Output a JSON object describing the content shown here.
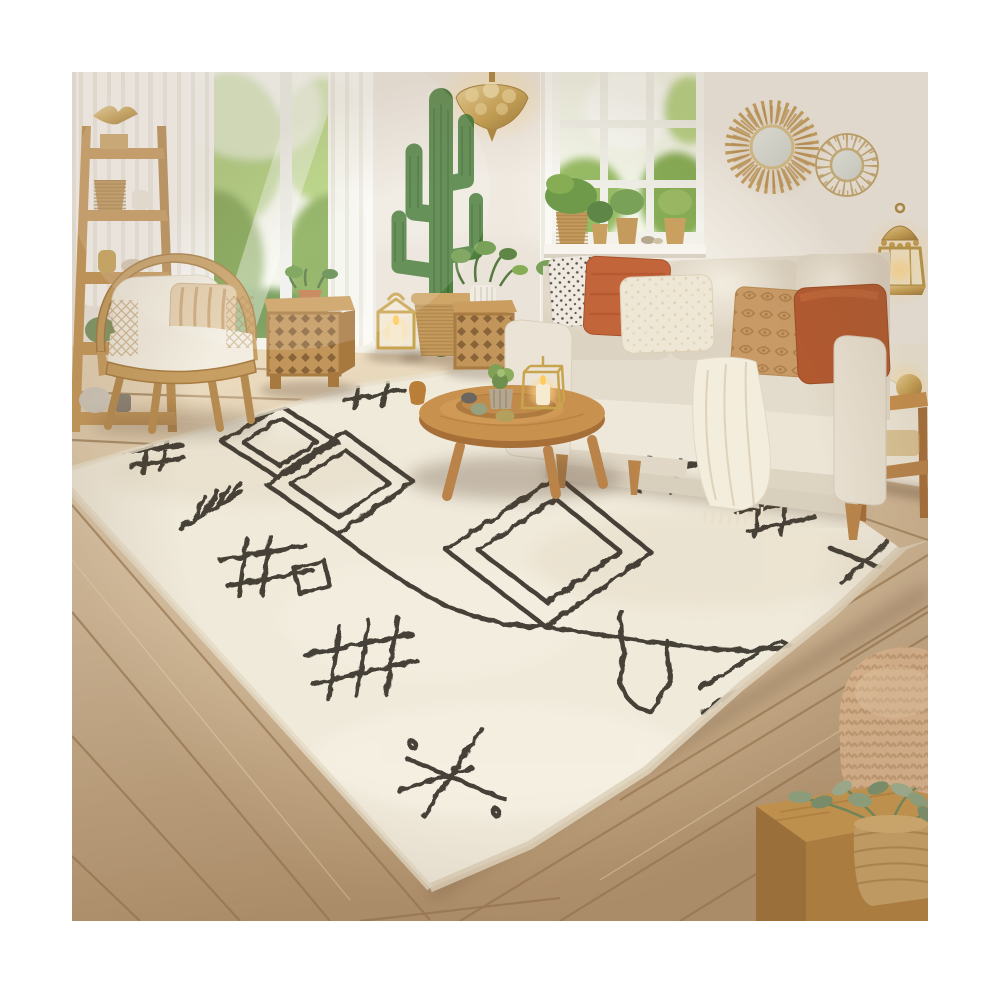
{
  "title": "Boho living room photo with ivory Berber shag rug",
  "colors": {
    "canvas": "#ffffff",
    "wall": "#efe9e0",
    "curtain": "#fbfaf6",
    "sky": "#f3f6e8",
    "foliage_light": "#b5d67e",
    "foliage": "#86ad54",
    "foliage_dark": "#6a934a",
    "floor_light": "#e8d7ba",
    "floor": "#d3bc9c",
    "floor_dark": "#b3946f",
    "floor_seam": "#97764f",
    "rug": "#f0eadb",
    "rug_edge": "#ded2ba",
    "rug_pattern": "#37332c",
    "sofa": "#ebe4d6",
    "sofa_dark": "#d9cfbd",
    "throw": "#f3edde",
    "pillow_dot_base": "#efe9df",
    "terracotta": "#c2653a",
    "burnt_orange": "#b2592f",
    "tan": "#c89a66",
    "cream_pillow": "#efe7d5",
    "wood": "#c8914d",
    "wood_dark": "#a7713a",
    "rattan": "#c79f62",
    "lattice_wood": "#c2955a",
    "brass": "#c8a253",
    "glow": "#ffd98e",
    "cactus": "#4d7f3e",
    "basket": "#c59b5d",
    "pouf": "#dcb791",
    "sage": "#8fa583",
    "mirror_glass": "#cfd5cc"
  },
  "objects": [
    {
      "name": "berber-rug",
      "desc": "ivory shag rug with charcoal diamonds and tribal motifs"
    },
    {
      "name": "sofa",
      "desc": "cream three-seat sofa with dotted, terracotta, cream, damask and orange pillows and fringed throw"
    },
    {
      "name": "coffee-table",
      "desc": "round wooden coffee table with tray, succulent, stone eggs and gold candle cube"
    },
    {
      "name": "rattan-armchair",
      "desc": "rattan armchair with white cushions and patterned pillow"
    },
    {
      "name": "ladder-shelf",
      "desc": "wooden ladder shelf with brass bird, basket, vases and figurines"
    },
    {
      "name": "carved-side-tables",
      "desc": "two carved lattice wooden side tables"
    },
    {
      "name": "cactus",
      "desc": "tall euphorbia cactus in woven basket"
    },
    {
      "name": "pendant-lamp",
      "desc": "ornate brass pendant lamp"
    },
    {
      "name": "candle-lanterns",
      "desc": "gold candle lanterns on floor and wall"
    },
    {
      "name": "wall-mirrors",
      "desc": "round raffia sunburst mirror and gold wire flower mirror"
    },
    {
      "name": "windows",
      "desc": "tall windows with sheer white curtains and green foliage outside"
    },
    {
      "name": "windowsill-plants",
      "desc": "potted plants in woven baskets on white sill"
    },
    {
      "name": "side-table-right",
      "desc": "wooden two-tier side table with brass decor"
    },
    {
      "name": "knit-pouf",
      "desc": "chunky knit pouf"
    },
    {
      "name": "plant-box",
      "desc": "wooden cube table with potted eucalyptus in basket"
    },
    {
      "name": "wood-floor",
      "desc": "light oak plank floor"
    }
  ]
}
